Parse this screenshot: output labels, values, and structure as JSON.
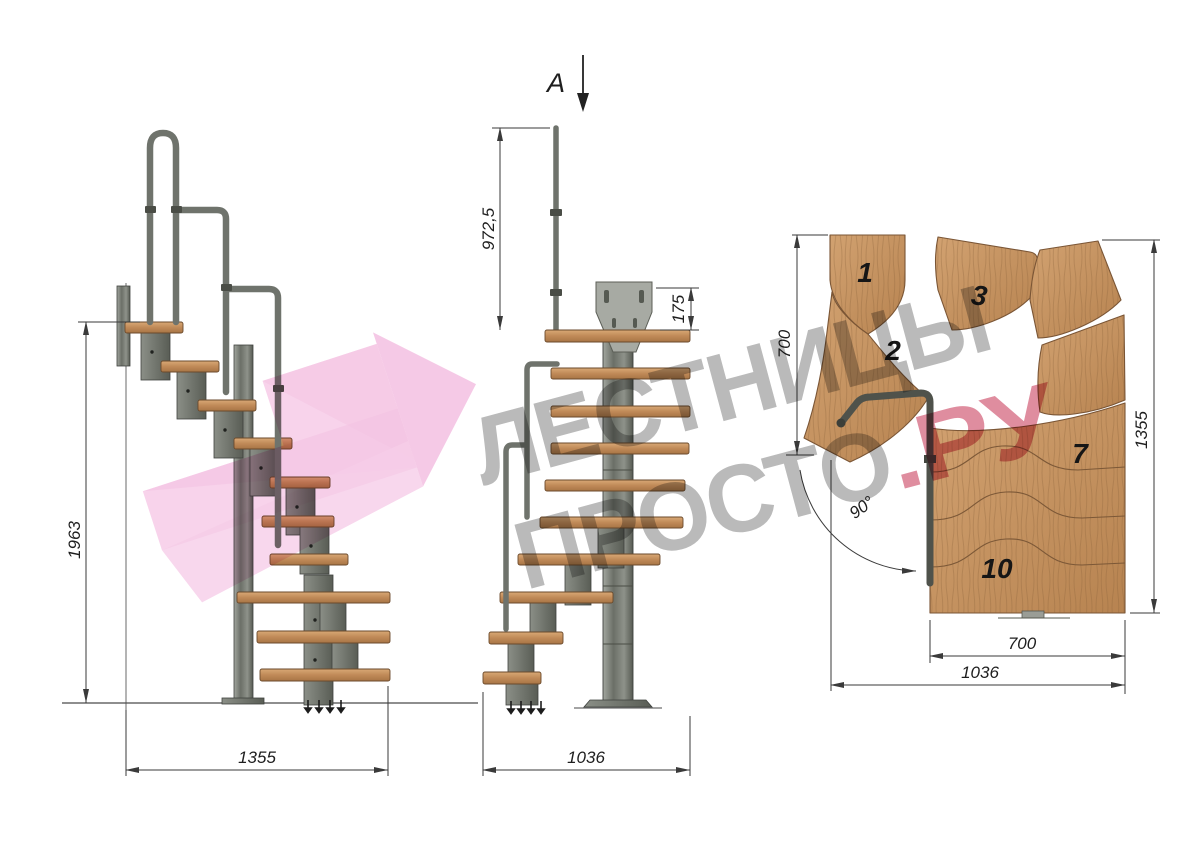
{
  "watermark": {
    "brand_line1": "ЛЕСТНИЦЫ",
    "brand_line2": "ПРОСТО",
    "brand_suffix": ".РУ",
    "pink_color": "#f5c6e4",
    "gray_text_color": "#9a9a9a",
    "red_text_color": "#c84a63"
  },
  "views": {
    "side": {
      "name": "side elevation",
      "dims": {
        "height": "1963",
        "length": "1355"
      }
    },
    "front": {
      "name": "front elevation",
      "section_label": "A",
      "dims": {
        "rail_height": "972,5",
        "plate_height": "175",
        "width": "1036"
      }
    },
    "plan": {
      "name": "top plan view",
      "dims": {
        "depth_top": "700",
        "height_right": "1355",
        "angle": "90°",
        "run_width": "700",
        "overall_width": "1036"
      },
      "treads": [
        {
          "label": "1"
        },
        {
          "label": "2"
        },
        {
          "label": "3"
        },
        {
          "label": "7"
        },
        {
          "label": "10"
        }
      ]
    }
  },
  "colors": {
    "wood": "#c49062",
    "metal": "#74786f",
    "dimension_lines": "#3a3a3a"
  }
}
